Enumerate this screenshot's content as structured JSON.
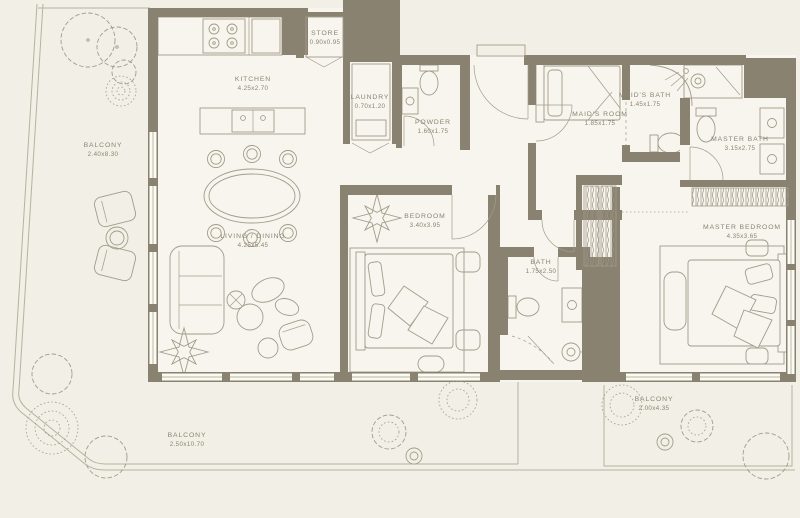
{
  "colors": {
    "background": "#f1efe6",
    "floor": "#f7f5ee",
    "wall": "#8a8271",
    "line": "#a39c89",
    "boundary": "#b8b19d",
    "text": "#8c8471"
  },
  "rooms": [
    {
      "id": "balcony-left",
      "name": "BALCONY",
      "dims": "2.40x8.30"
    },
    {
      "id": "kitchen",
      "name": "KITCHEN",
      "dims": "4.25x2.70"
    },
    {
      "id": "store",
      "name": "STORE",
      "dims": "0.90x0.95"
    },
    {
      "id": "laundry",
      "name": "LAUNDRY",
      "dims": "0.70x1.20"
    },
    {
      "id": "powder",
      "name": "POWDER",
      "dims": "1.60x1.75"
    },
    {
      "id": "living-dining",
      "name": "LIVING / DINING",
      "dims": "4.25x5.45"
    },
    {
      "id": "bedroom",
      "name": "BEDROOM",
      "dims": "3.40x3.95"
    },
    {
      "id": "maids-room",
      "name": "MAID'S ROOM",
      "dims": "1.85x1.75"
    },
    {
      "id": "maids-bath",
      "name": "MAID'S BATH",
      "dims": "1.45x1.75"
    },
    {
      "id": "master-bath",
      "name": "MASTER BATH",
      "dims": "3.15x2.75"
    },
    {
      "id": "master-bedroom",
      "name": "MASTER BEDROOM",
      "dims": "4.35x3.65"
    },
    {
      "id": "bath",
      "name": "BATH",
      "dims": "1.75x2.50"
    },
    {
      "id": "balcony-bottom",
      "name": "BALCONY",
      "dims": "2.50x10.70"
    },
    {
      "id": "balcony-right",
      "name": "BALCONY",
      "dims": "2.00x4.35"
    }
  ]
}
